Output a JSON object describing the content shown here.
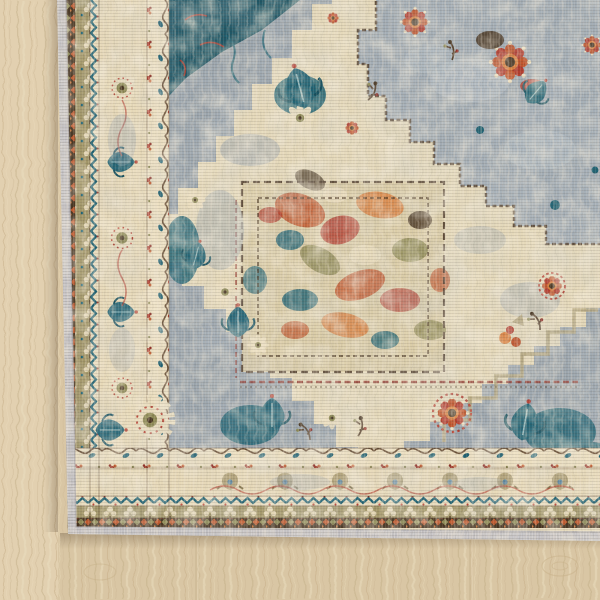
{
  "scene": {
    "subject": "corner of a distressed vintage-style oriental area rug",
    "setting": "light oak wood plank floor",
    "view": "overhead corner view, rug fills upper right, floor visible along left edge and bottom",
    "visible_text": ""
  },
  "palette": {
    "wood_base": "#d9c6a4",
    "wood_left": "#e7d7b9",
    "wood_grain_dark": "#c8b18a",
    "wood_grain_light": "#eee0c4",
    "binding_gray": "#c2bfc1",
    "rug_ivory": "#e9dcbc",
    "border_ivory": "#e7d9b8",
    "guard_cream": "#ecdfc0",
    "olive_band": "#a39769",
    "field_gray": "#9ca6ae",
    "field_gray_light": "#b6bfc6",
    "medallion_cream": "#e8dbba",
    "interior_gray": "#a3adb5",
    "core_base": "#d9cba6",
    "teal": "#1e6172",
    "teal_dark": "#15505f",
    "rust": "#c05a2e",
    "orange": "#d97f3e",
    "red": "#b23c2e",
    "red_dark": "#8e2f26",
    "olive": "#8e8a55",
    "tan": "#b0a178",
    "brown": "#5a4430",
    "brown_dark": "#46331f"
  },
  "rug": {
    "parts": {
      "binding": "gray serged edge binding",
      "diamond_band": "dark brown band with rust and olive diamond chain",
      "outer_guard": "olive band with cream trefoils",
      "zigzag_guard": "teal zigzag on cream",
      "main_border": "ivory border with cream sunburst rosettes and teal palmettes",
      "inner_guard": "cream vine band with red blossoms and teal leaves",
      "field": "slate gray-blue heavily distressed field",
      "spandrel": "dark teal corner spandrel with red tracery",
      "medallion": "large stepped cream medallion",
      "medallion_interior": "gray-blue stepped interior with red rosette sprays",
      "core": "multicolor floral core panel framed by thin brown lines"
    }
  },
  "floor": {
    "material": "light oak planks",
    "grain": "vertical grain streaks with faint seams and knots"
  }
}
